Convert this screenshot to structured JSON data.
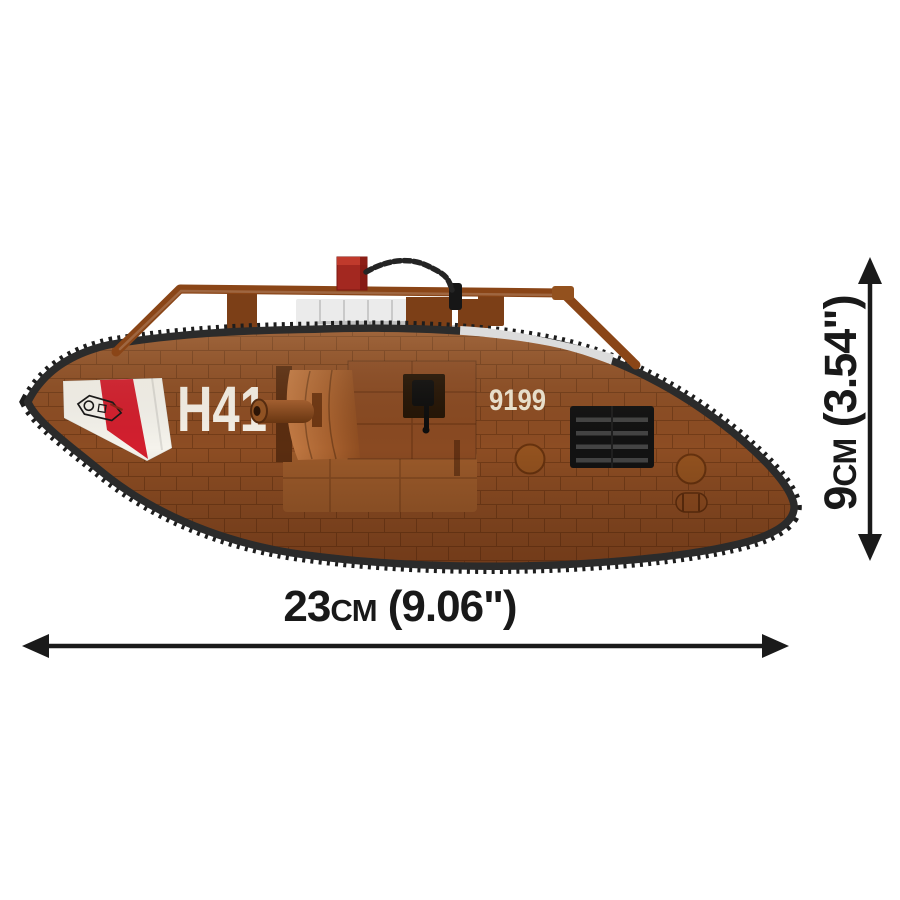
{
  "product": {
    "description": "COBI brick-built WWI Mark V rhomboid tank model, side profile view",
    "markings": {
      "code": "H41",
      "serial": "9199"
    },
    "colors": {
      "hull_brown": "#8d4d23",
      "hull_brown_light": "#c27a44",
      "sponson_skirt": "#9b5a2a",
      "rail_brown": "#8a4517",
      "track_dark": "#2b2b2b",
      "track_teeth": "#1d1d1d",
      "track_light_links": "#dcdcdc",
      "nose_panel_white": "#f5f3ec",
      "nose_stripe_red": "#d31f2e",
      "beam_block_red": "#a32820",
      "silencer_gray": "#c2c2c2",
      "marking_white": "#f6f1e7",
      "serial_cream": "#f0e7d2",
      "grille_black": "#121212"
    }
  },
  "dimensions": {
    "width_label": "23cm (9.06\")",
    "height_label": "9cm (3.54\")",
    "arrow_color": "#1a1a1a"
  }
}
